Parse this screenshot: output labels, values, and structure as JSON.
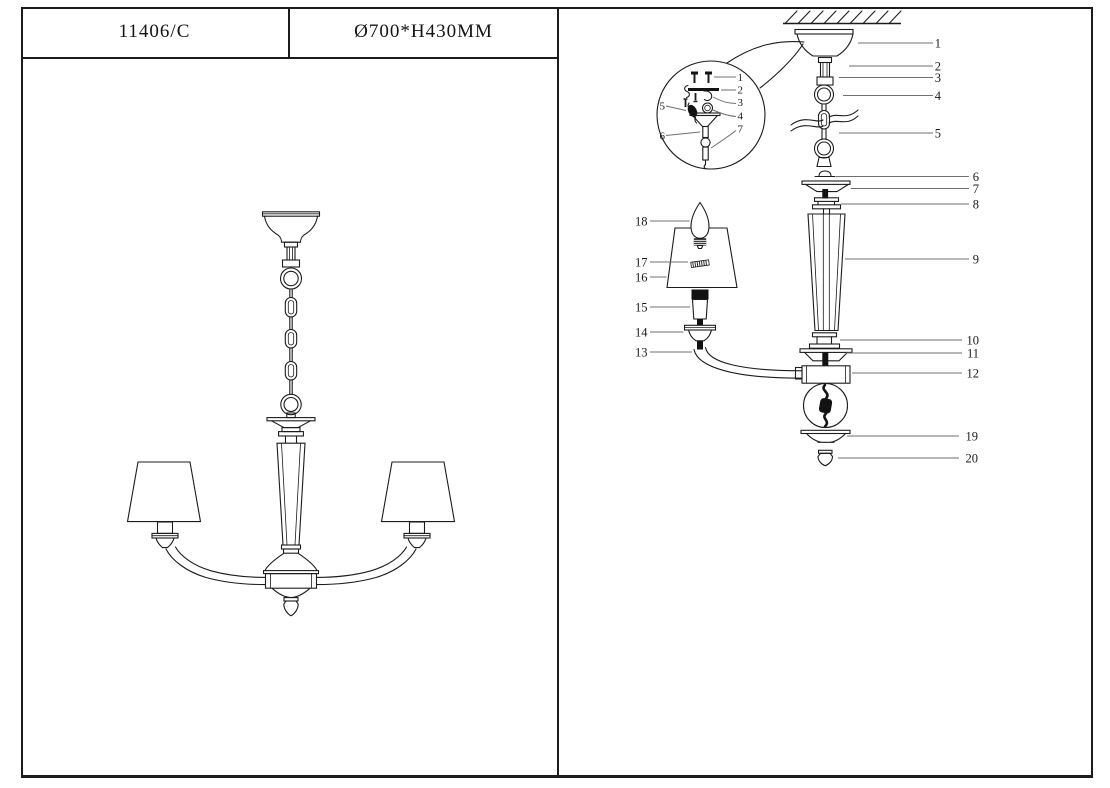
{
  "header": {
    "model": "11406/C",
    "size": "Ø700*H430MM"
  },
  "colors": {
    "line": "#1c1c1c",
    "leader": "#6f6f6f",
    "background": "#ffffff"
  },
  "exploded_view": {
    "right_labels": [
      "1",
      "2",
      "3",
      "4",
      "5",
      "6",
      "7",
      "8",
      "9",
      "10",
      "11",
      "12"
    ],
    "bottom_labels": [
      "19",
      "20"
    ],
    "left_labels": [
      "18",
      "17",
      "16",
      "15",
      "14",
      "13"
    ],
    "inset_labels": [
      "1",
      "2",
      "3",
      "4",
      "5",
      "6",
      "7"
    ]
  }
}
